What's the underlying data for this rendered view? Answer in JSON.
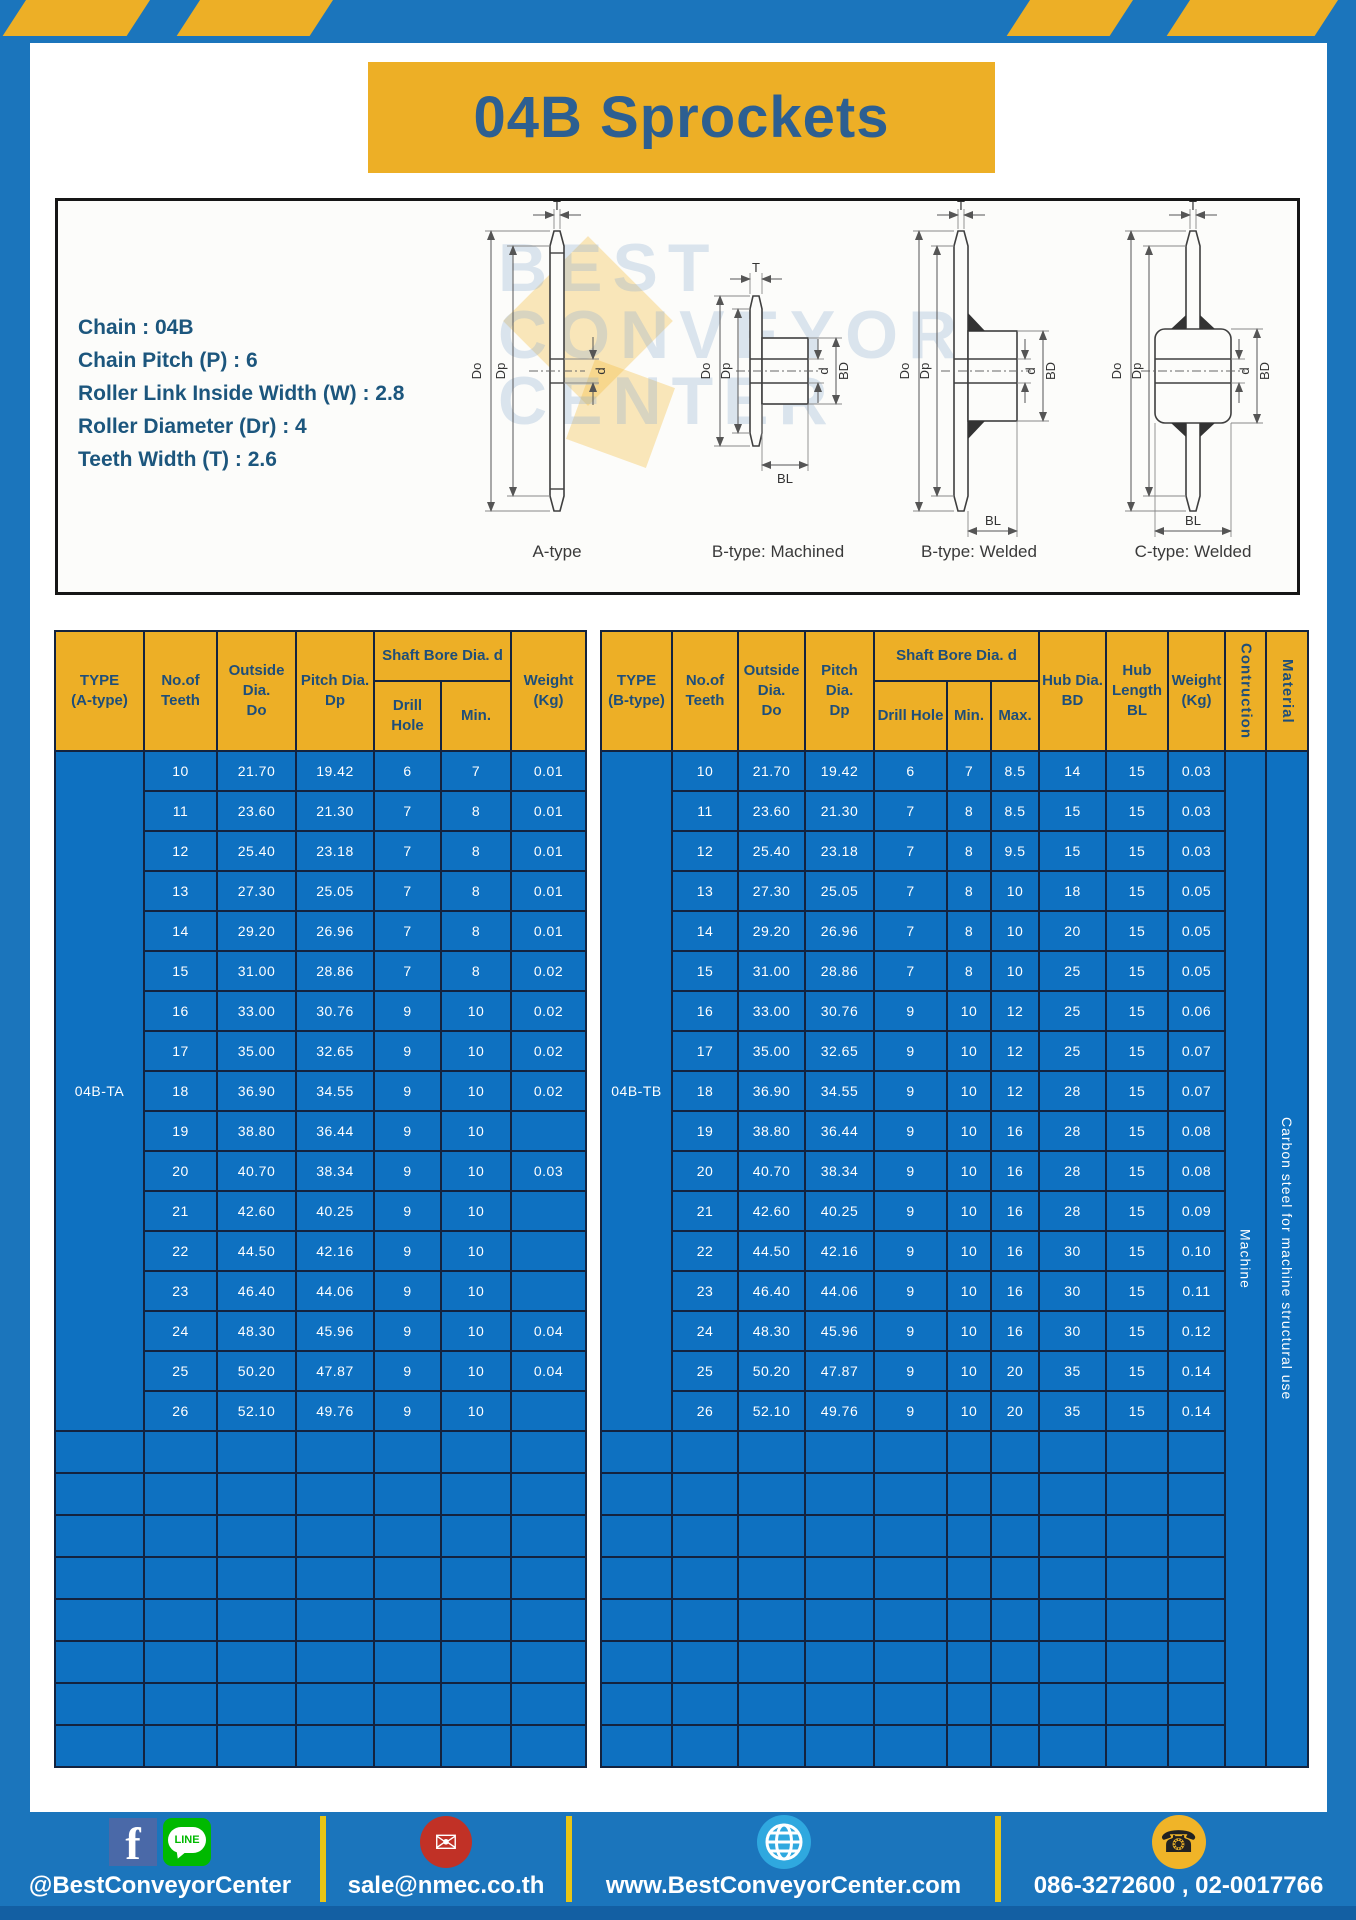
{
  "page": {
    "title": "04B Sprockets"
  },
  "specs": {
    "lines": [
      "Chain : 04B",
      "Chain Pitch (P) : 6",
      "Roller Link Inside Width (W) : 2.8",
      "Roller Diameter (Dr) : 4",
      "Teeth Width (T) : 2.6"
    ]
  },
  "drawings": {
    "watermark_lines": [
      "BEST",
      "CONVEYOR",
      "CENTER"
    ],
    "figures": [
      {
        "label": "A-type",
        "dims": [
          "T",
          "Do",
          "Dp",
          "d"
        ]
      },
      {
        "label": "B-type: Machined",
        "dims": [
          "T",
          "Do",
          "Dp",
          "d",
          "BD",
          "BL"
        ]
      },
      {
        "label": "B-type: Welded",
        "dims": [
          "T",
          "Do",
          "Dp",
          "d",
          "BD",
          "BL"
        ]
      },
      {
        "label": "C-type: Welded",
        "dims": [
          "T",
          "Do",
          "Dp",
          "d",
          "BD",
          "BL"
        ]
      }
    ]
  },
  "tables": [
    {
      "name": "table-04b-ta",
      "col_widths": [
        89,
        73,
        79,
        78,
        67,
        70,
        75
      ],
      "header": [
        [
          {
            "t": "TYPE\n(A-type)",
            "rs": 2
          },
          {
            "t": "No.of\nTeeth",
            "rs": 2
          },
          {
            "t": "Outside\nDia.\nDo",
            "rs": 2
          },
          {
            "t": "Pitch Dia.\nDp",
            "rs": 2
          },
          {
            "t": "Shaft Bore Dia. d",
            "cs": 2
          },
          {
            "t": "Weight\n(Kg)",
            "rs": 2
          }
        ],
        [
          {
            "t": "Drill Hole"
          },
          {
            "t": "Min."
          }
        ]
      ],
      "type_label": "04B-TA",
      "rows": [
        [
          "10",
          "21.70",
          "19.42",
          "6",
          "7",
          "0.01"
        ],
        [
          "11",
          "23.60",
          "21.30",
          "7",
          "8",
          "0.01"
        ],
        [
          "12",
          "25.40",
          "23.18",
          "7",
          "8",
          "0.01"
        ],
        [
          "13",
          "27.30",
          "25.05",
          "7",
          "8",
          "0.01"
        ],
        [
          "14",
          "29.20",
          "26.96",
          "7",
          "8",
          "0.01"
        ],
        [
          "15",
          "31.00",
          "28.86",
          "7",
          "8",
          "0.02"
        ],
        [
          "16",
          "33.00",
          "30.76",
          "9",
          "10",
          "0.02"
        ],
        [
          "17",
          "35.00",
          "32.65",
          "9",
          "10",
          "0.02"
        ],
        [
          "18",
          "36.90",
          "34.55",
          "9",
          "10",
          "0.02"
        ],
        [
          "19",
          "38.80",
          "36.44",
          "9",
          "10",
          ""
        ],
        [
          "20",
          "40.70",
          "38.34",
          "9",
          "10",
          "0.03"
        ],
        [
          "21",
          "42.60",
          "40.25",
          "9",
          "10",
          ""
        ],
        [
          "22",
          "44.50",
          "42.16",
          "9",
          "10",
          ""
        ],
        [
          "23",
          "46.40",
          "44.06",
          "9",
          "10",
          ""
        ],
        [
          "24",
          "48.30",
          "45.96",
          "9",
          "10",
          "0.04"
        ],
        [
          "25",
          "50.20",
          "47.87",
          "9",
          "10",
          "0.04"
        ],
        [
          "26",
          "52.10",
          "49.76",
          "9",
          "10",
          ""
        ]
      ],
      "trailing_rows": 8,
      "trailing_cols": 7
    },
    {
      "name": "table-04b-tb",
      "col_widths": [
        71,
        66,
        67,
        69,
        73,
        44,
        48,
        67,
        62,
        57,
        41,
        42
      ],
      "header": [
        [
          {
            "t": "TYPE\n(B-type)",
            "rs": 2
          },
          {
            "t": "No.of\nTeeth",
            "rs": 2
          },
          {
            "t": "Outside\nDia.\nDo",
            "rs": 2
          },
          {
            "t": "Pitch Dia.\nDp",
            "rs": 2
          },
          {
            "t": "Shaft Bore Dia. d",
            "cs": 3
          },
          {
            "t": "Hub Dia.\nBD",
            "rs": 2
          },
          {
            "t": "Hub\nLength\nBL",
            "rs": 2
          },
          {
            "t": "Weight\n(Kg)",
            "rs": 2
          },
          {
            "t": "Contruction",
            "rs": 2,
            "v": 1
          },
          {
            "t": "Material",
            "rs": 2,
            "v": 1
          }
        ],
        [
          {
            "t": "Drill Hole"
          },
          {
            "t": "Min."
          },
          {
            "t": "Max."
          }
        ]
      ],
      "type_label": "04B-TB",
      "rows": [
        [
          "10",
          "21.70",
          "19.42",
          "6",
          "7",
          "8.5",
          "14",
          "15",
          "0.03"
        ],
        [
          "11",
          "23.60",
          "21.30",
          "7",
          "8",
          "8.5",
          "15",
          "15",
          "0.03"
        ],
        [
          "12",
          "25.40",
          "23.18",
          "7",
          "8",
          "9.5",
          "15",
          "15",
          "0.03"
        ],
        [
          "13",
          "27.30",
          "25.05",
          "7",
          "8",
          "10",
          "18",
          "15",
          "0.05"
        ],
        [
          "14",
          "29.20",
          "26.96",
          "7",
          "8",
          "10",
          "20",
          "15",
          "0.05"
        ],
        [
          "15",
          "31.00",
          "28.86",
          "7",
          "8",
          "10",
          "25",
          "15",
          "0.05"
        ],
        [
          "16",
          "33.00",
          "30.76",
          "9",
          "10",
          "12",
          "25",
          "15",
          "0.06"
        ],
        [
          "17",
          "35.00",
          "32.65",
          "9",
          "10",
          "12",
          "25",
          "15",
          "0.07"
        ],
        [
          "18",
          "36.90",
          "34.55",
          "9",
          "10",
          "12",
          "28",
          "15",
          "0.07"
        ],
        [
          "19",
          "38.80",
          "36.44",
          "9",
          "10",
          "16",
          "28",
          "15",
          "0.08"
        ],
        [
          "20",
          "40.70",
          "38.34",
          "9",
          "10",
          "16",
          "28",
          "15",
          "0.08"
        ],
        [
          "21",
          "42.60",
          "40.25",
          "9",
          "10",
          "16",
          "28",
          "15",
          "0.09"
        ],
        [
          "22",
          "44.50",
          "42.16",
          "9",
          "10",
          "16",
          "30",
          "15",
          "0.10"
        ],
        [
          "23",
          "46.40",
          "44.06",
          "9",
          "10",
          "16",
          "30",
          "15",
          "0.11"
        ],
        [
          "24",
          "48.30",
          "45.96",
          "9",
          "10",
          "16",
          "30",
          "15",
          "0.12"
        ],
        [
          "25",
          "50.20",
          "47.87",
          "9",
          "10",
          "20",
          "35",
          "15",
          "0.14"
        ],
        [
          "26",
          "52.10",
          "49.76",
          "9",
          "10",
          "20",
          "35",
          "15",
          "0.14"
        ]
      ],
      "trailing_rows": 8,
      "trailing_cols": 10,
      "merged_cols": [
        {
          "t": "Machine",
          "v": 1
        },
        {
          "t": "Carbon steel for machine structural use",
          "v": 1
        }
      ]
    }
  ],
  "footer": {
    "facebook_glyph": "f",
    "line_label": "LINE",
    "mail_glyph": "✉",
    "phone_glyph": "☎",
    "sections": [
      {
        "text": "@BestConveyorCenter"
      },
      {
        "text": "sale@nmec.co.th"
      },
      {
        "text": "www.BestConveyorCenter.com"
      },
      {
        "text": "086-3272600 , 02-0017766"
      }
    ]
  },
  "colors": {
    "page_blue": "#1B75BC",
    "footer_dark_blue": "#135FA3",
    "accent_yellow": "#EDAF26",
    "table_cell_blue": "#0E71C1",
    "table_border_navy": "#13233F",
    "header_text_navy": "#1E4E7A",
    "title_text_blue": "#2D5F91",
    "spec_text_blue": "#1C567D"
  }
}
